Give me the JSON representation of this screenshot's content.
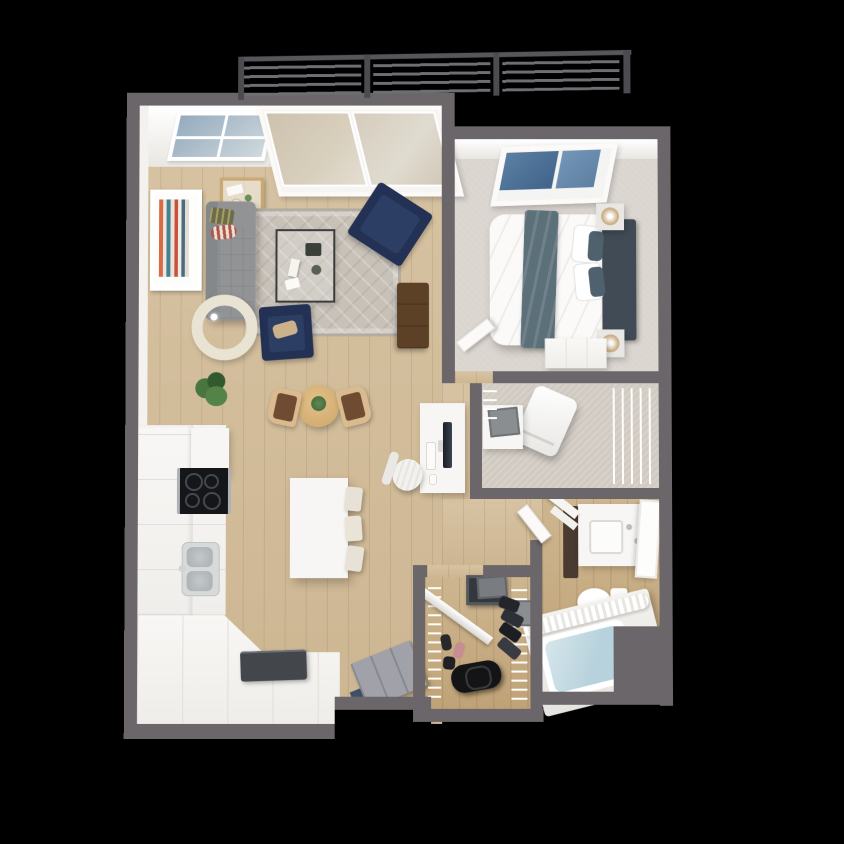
{
  "scene": {
    "kind": "3d-floor-plan-render",
    "view": "top-down isometric cutaway",
    "description": "One-bedroom apartment 3D floor plan on black background with balcony at top",
    "visible_text": "none"
  },
  "palette": {
    "wall": "#6b6669",
    "wallFace": "#f4f2ef",
    "white": "#f7f6f4",
    "counterSeam": "#e2dfda",
    "woodA": "#d7c3a3",
    "woodB": "#cdb692",
    "closetWoodA": "#cdb68f",
    "closetWoodB": "#c0a277",
    "carpet": "#dad5cf",
    "laundryFloor": "#d6d0c8",
    "rug": "#c7c1b8",
    "rugPattern": "#b3aca0",
    "navy": "#223154",
    "navyCushion": "#2c3e64",
    "sofa": "#919395",
    "sofaBack": "#85888b",
    "blanket": "#5c707a",
    "headboard": "#404b55",
    "pillowSlate": "#4e616c",
    "railing": "#6e6e73",
    "railingPost": "#4c4c50",
    "railTop": "#56565b",
    "glassSky": "#5c7fa3",
    "glassSky2": "#7496b7",
    "glassPale": "#c3cfd4",
    "water": "#b7d2dc",
    "steel": "#aeb2b4",
    "sinkSteel": "#a9aeb0",
    "cooktop": "#151619",
    "tableWood": "#d3ae73",
    "chairWood": "#d9bb8f",
    "chairSeat": "#6f4b31",
    "green": "#49753f",
    "greenDark": "#33592e",
    "lampShade": "#e9e3d3",
    "doorGray": "#a1a1a9",
    "doorMat": "#3e5069",
    "walnut": "#5d4126",
    "laptop": "#43474c",
    "duffel": "#141416",
    "mirrorDark": "#34373b",
    "binGray": "#8b8e91",
    "tanPillow": "#ccb28b",
    "artOrange": "#d96a43",
    "artTeal": "#44808d",
    "artRed": "#c8503c",
    "artBlue": "#4a6b82",
    "background": "#000000"
  },
  "rooms": [
    {
      "name": "balcony",
      "items": [
        "metal-slat-railing"
      ]
    },
    {
      "name": "living-room",
      "items": [
        "gray-sofa",
        "striped-pillows",
        "area-rug",
        "glass-coffee-table",
        "navy-armchair",
        "navy-accent-chair",
        "floor-lamp",
        "bar-cart",
        "wall-art",
        "potted-plant",
        "media-console",
        "sliding-glass-door",
        "transom-window",
        "desk",
        "imac-monitor",
        "keyboard",
        "mouse",
        "office-chair"
      ]
    },
    {
      "name": "dining-area",
      "items": [
        "round-dining-table",
        "dining-chair-left",
        "dining-chair-right",
        "centerpiece-plant"
      ]
    },
    {
      "name": "kitchen",
      "items": [
        "l-shaped-counter",
        "upper-cabinets",
        "fridge-cabinet",
        "cooktop",
        "double-sink",
        "island",
        "bar-stool-1",
        "bar-stool-2",
        "bar-stool-3",
        "laptop-on-counter"
      ]
    },
    {
      "name": "bedroom",
      "items": [
        "queen-bed",
        "duvet",
        "throw-blanket",
        "pillows",
        "headboard",
        "nightstand-top",
        "nightstand-bottom",
        "table-lamps",
        "skylight-window",
        "dresser",
        "bedroom-door"
      ]
    },
    {
      "name": "laundry-closet",
      "items": [
        "washer-tilted",
        "dryer-with-basket",
        "wire-shelving"
      ]
    },
    {
      "name": "bathroom",
      "items": [
        "bathroom-door",
        "corner-shelves",
        "linen-cabinet",
        "vanity",
        "sink",
        "mirror-panel",
        "toilet",
        "bathtub",
        "tub-water",
        "shower-curtain"
      ]
    },
    {
      "name": "walk-in-closet",
      "items": [
        "wire-shelves",
        "hanging-clothes",
        "closet-mirror",
        "storage-bins",
        "duffel-bag",
        "shoes",
        "shelf-rod"
      ]
    },
    {
      "name": "entry",
      "items": [
        "front-door",
        "door-mat"
      ]
    }
  ]
}
